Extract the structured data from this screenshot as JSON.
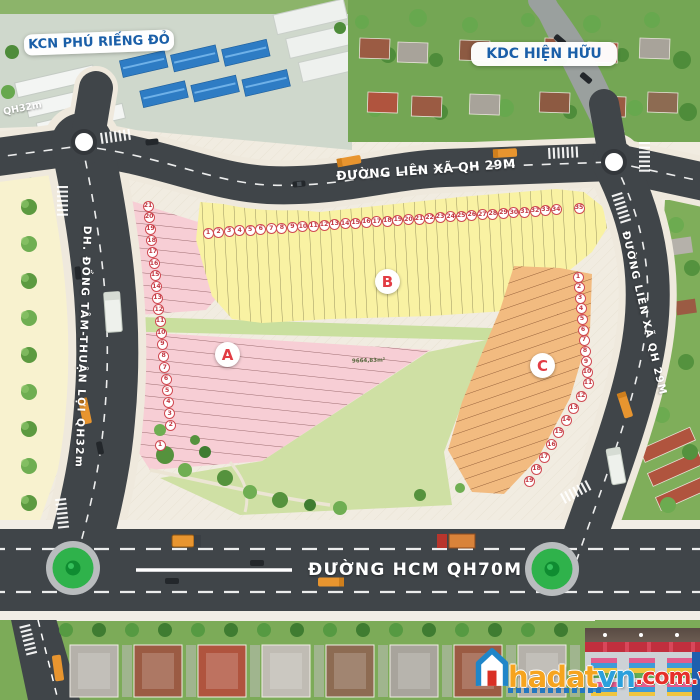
{
  "landmarks": {
    "industrial_zone": "KCN PHÚ RIẾNG ĐỎ",
    "existing_residential": "KDC HIỆN HỮU"
  },
  "roads": {
    "top": "ĐƯỜNG LIÊN XÃ QH 29M",
    "right": "ĐƯỜNG LIÊN XÃ QH 29M",
    "left": "DH. ĐỒNG TÂM-THUẬN LỢI QH32m",
    "left_corner_tag": "QH32m",
    "bottom": "ĐƯỜNG HCM QH70M"
  },
  "zones": [
    {
      "id": "A",
      "label": "A",
      "fill": "#f7ced5",
      "lots": [
        1,
        2,
        3,
        4,
        5,
        6,
        7,
        8,
        9,
        10,
        11,
        12,
        13,
        14,
        15,
        16,
        17,
        18,
        19,
        20,
        21
      ]
    },
    {
      "id": "B",
      "label": "B",
      "fill": "#f9f2a3",
      "lots": [
        1,
        2,
        3,
        4,
        5,
        6,
        7,
        8,
        9,
        10,
        11,
        12,
        13,
        14,
        15,
        16,
        17,
        18,
        19,
        20,
        21,
        22,
        23,
        24,
        25,
        26,
        27,
        28,
        29,
        30,
        31,
        32,
        33,
        34,
        35
      ]
    },
    {
      "id": "C",
      "label": "C",
      "fill": "#f2bb80",
      "lots": [
        1,
        2,
        3,
        4,
        5,
        6,
        7,
        8,
        9,
        10,
        11,
        12,
        13,
        14,
        15,
        16,
        17,
        18,
        19
      ]
    }
  ],
  "park": {
    "area_label": "9664,83m²"
  },
  "watermark": {
    "brand_head": "hadat",
    "brand_tail": "vn",
    "brand_domain": ".com.vn"
  },
  "colors": {
    "road": "#404549",
    "sidewalk": "#f1ece1",
    "roundabout_green": "#2fb24b",
    "zone_a": "#f7ced5",
    "zone_b": "#f9f2a3",
    "zone_c": "#f2bb80",
    "park": "#cfe0a4",
    "accent_red": "#d8414b",
    "label_blue": "#1a5fa8"
  }
}
